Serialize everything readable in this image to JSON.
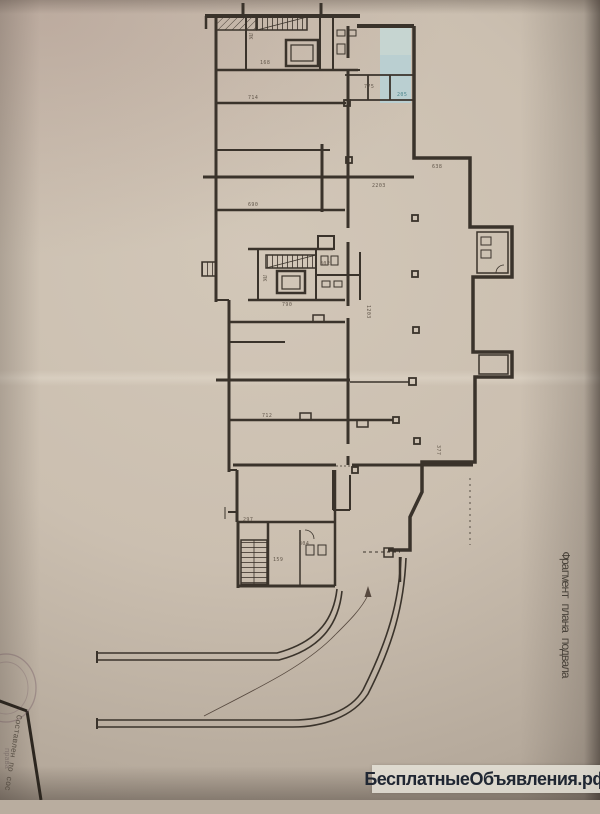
{
  "photo": {
    "paper_color": "#cbbfb0",
    "ink_color": "#3a332b",
    "highlight_color": "#b9d0d4",
    "watermark_bg": "#e4e0d6"
  },
  "caption": {
    "text": "Фрагмент плана подвала"
  },
  "title_block": {
    "note": "Составлен по сос",
    "note_faint": "права"
  },
  "watermark": {
    "text": "БесплатныеОбъявления.рф"
  },
  "plan": {
    "type": "basement-floor-plan",
    "highlight": {
      "x": 380,
      "y": 25,
      "w": 31,
      "h": 78
    },
    "labels": [
      {
        "t": "ЛК",
        "x": 253,
        "y": 33,
        "r": 90
      },
      {
        "t": "168",
        "x": 260,
        "y": 60
      },
      {
        "t": "714",
        "x": 248,
        "y": 95
      },
      {
        "t": "775",
        "x": 364,
        "y": 84
      },
      {
        "t": "205",
        "x": 397,
        "y": 92,
        "c": "teal"
      },
      {
        "t": "638",
        "x": 432,
        "y": 164
      },
      {
        "t": "2203",
        "x": 372,
        "y": 183
      },
      {
        "t": "690",
        "x": 248,
        "y": 202
      },
      {
        "t": "ЛК",
        "x": 267,
        "y": 275,
        "r": 90
      },
      {
        "t": "302",
        "x": 320,
        "y": 261
      },
      {
        "t": "790",
        "x": 282,
        "y": 302
      },
      {
        "t": "1203",
        "x": 371,
        "y": 305,
        "r": 90
      },
      {
        "t": "712",
        "x": 262,
        "y": 413
      },
      {
        "t": "377",
        "x": 441,
        "y": 445,
        "r": 90
      },
      {
        "t": "297",
        "x": 243,
        "y": 517
      },
      {
        "t": "304",
        "x": 299,
        "y": 541
      },
      {
        "t": "159",
        "x": 273,
        "y": 557
      }
    ]
  }
}
